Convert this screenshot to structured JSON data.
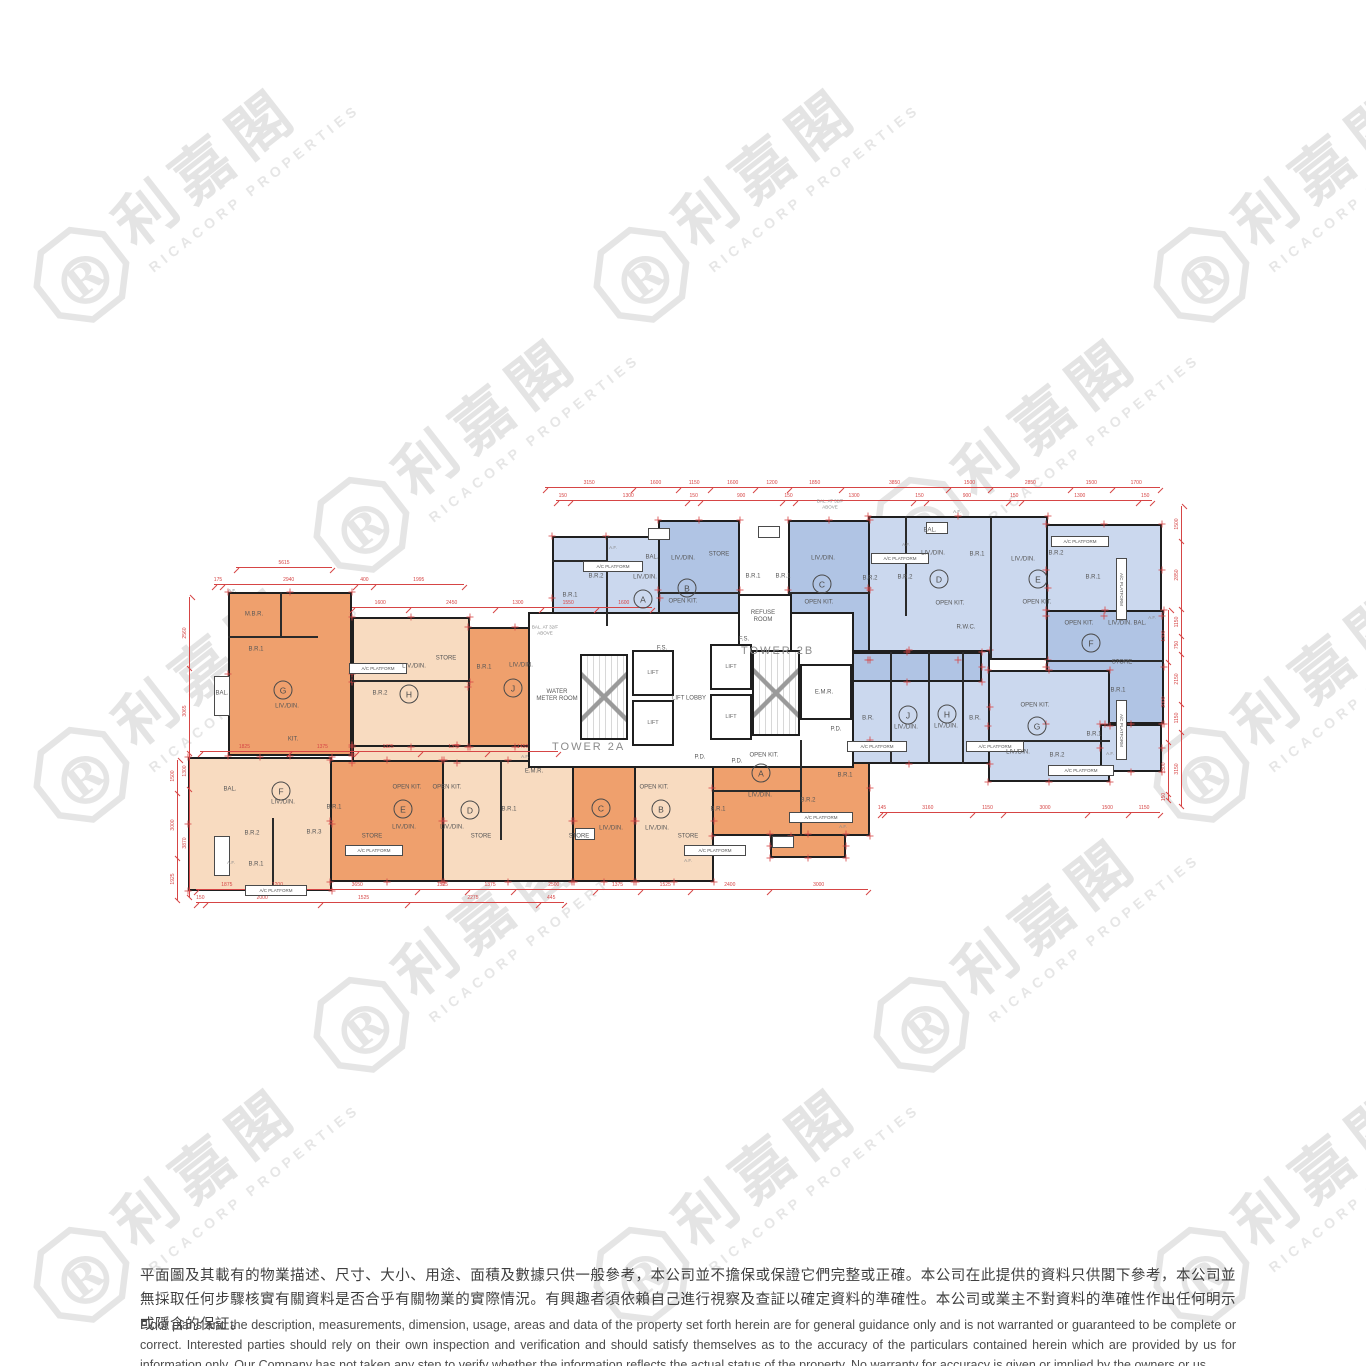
{
  "watermark": {
    "logo_letter": "R",
    "cjk": "利嘉閣",
    "latin": "RICACORP PROPERTIES"
  },
  "disclaimer": {
    "zh": "平面圖及其載有的物業描述、尺寸、大小、用途、面積及數據只供一般參考，本公司並不擔保或保證它們完整或正確。本公司在此提供的資料只供閣下參考，本公司並無採取任何步驟核實有關資料是否合乎有關物業的實際情況。有興趣者須依賴自己進行視察及查証以確定資料的準確性。本公司或業主不對資料的準確性作出任何明示或隱含的保証。",
    "en": "Floor plans and the description, measurements, dimension, usage, areas and data of the property set forth herein are for general guidance only and is not warranted or guaranteed to be complete or correct.  Interested parties should rely on their own inspection and verification and should satisfy themselves as to the accuracy of the particulars contained herein which are provided by us for information only.  Our Company has not taken any step to verify whether the information reflects the actual status of the property.  No warranty for accuracy is given or implied by the owners or us."
  },
  "plan": {
    "towers": [
      {
        "x": 552,
        "y": 741,
        "label": "TOWER 2A"
      },
      {
        "x": 741,
        "y": 645,
        "label": "TOWER 2B"
      }
    ],
    "blocks": [
      [
        228,
        592,
        124,
        164,
        "do"
      ],
      [
        352,
        617,
        118,
        130,
        "lo"
      ],
      [
        468,
        627,
        94,
        120,
        "do"
      ],
      [
        352,
        745,
        210,
        18,
        "lo"
      ],
      [
        188,
        757,
        144,
        134,
        "lo"
      ],
      [
        330,
        760,
        114,
        122,
        "do"
      ],
      [
        442,
        760,
        132,
        122,
        "lo"
      ],
      [
        572,
        760,
        64,
        122,
        "do"
      ],
      [
        634,
        760,
        80,
        122,
        "lo"
      ],
      [
        712,
        740,
        158,
        96,
        "do"
      ],
      [
        770,
        834,
        76,
        24,
        "do"
      ],
      [
        552,
        536,
        108,
        124,
        "lb"
      ],
      [
        658,
        520,
        82,
        140,
        "db"
      ],
      [
        788,
        520,
        82,
        140,
        "db"
      ],
      [
        868,
        516,
        180,
        144,
        "lb"
      ],
      [
        1046,
        524,
        116,
        92,
        "lb"
      ],
      [
        1046,
        610,
        118,
        114,
        "db"
      ],
      [
        828,
        650,
        162,
        114,
        "lb"
      ],
      [
        832,
        652,
        150,
        30,
        "db"
      ],
      [
        988,
        670,
        122,
        112,
        "lb"
      ],
      [
        1100,
        724,
        62,
        48,
        "lb"
      ],
      [
        528,
        612,
        326,
        156,
        "wh"
      ],
      [
        738,
        594,
        54,
        70,
        "wh"
      ],
      [
        800,
        664,
        52,
        56,
        "wh"
      ]
    ],
    "iwalls": [
      [
        272,
        818,
        1.5,
        73
      ],
      [
        352,
        680,
        118,
        1.5
      ],
      [
        228,
        636,
        90,
        1.5
      ],
      [
        280,
        592,
        1.5,
        44
      ],
      [
        500,
        760,
        1.5,
        80
      ],
      [
        800,
        740,
        1.5,
        96
      ],
      [
        712,
        790,
        90,
        1.5
      ],
      [
        606,
        536,
        1.5,
        90
      ],
      [
        552,
        560,
        54,
        1.5
      ],
      [
        658,
        592,
        82,
        1.5
      ],
      [
        788,
        592,
        82,
        1.5
      ],
      [
        905,
        516,
        1.5,
        100
      ],
      [
        990,
        516,
        1.5,
        144
      ],
      [
        1046,
        660,
        118,
        1.5
      ],
      [
        890,
        652,
        1.5,
        112
      ],
      [
        928,
        652,
        1.5,
        112
      ],
      [
        962,
        652,
        1.5,
        112
      ],
      [
        988,
        740,
        122,
        1.5
      ]
    ],
    "stairs": [
      [
        580,
        654,
        48,
        86
      ],
      [
        752,
        650,
        48,
        86
      ]
    ],
    "lifts": [
      [
        632,
        650,
        42,
        46,
        "LIFT"
      ],
      [
        632,
        700,
        42,
        46,
        "LIFT"
      ],
      [
        710,
        644,
        42,
        46,
        "LIFT"
      ],
      [
        710,
        694,
        42,
        46,
        "LIFT"
      ]
    ],
    "boxes": [
      [
        349,
        663,
        58,
        11,
        "A/C PLATFORM",
        false
      ],
      [
        583,
        561,
        60,
        11,
        "A/C PLATFORM",
        false
      ],
      [
        871,
        553,
        58,
        11,
        "A/C PLATFORM",
        false
      ],
      [
        1051,
        536,
        58,
        11,
        "A/C PLATFORM",
        false
      ],
      [
        1116,
        558,
        11,
        62,
        "A/C PLATFORM",
        true
      ],
      [
        789,
        812,
        64,
        11,
        "A/C PLATFORM",
        false
      ],
      [
        684,
        845,
        62,
        11,
        "A/C PLATFORM",
        false
      ],
      [
        345,
        845,
        58,
        11,
        "A/C PLATFORM",
        false
      ],
      [
        245,
        885,
        62,
        11,
        "A/C PLATFORM",
        false
      ],
      [
        847,
        741,
        60,
        11,
        "A/C PLATFORM",
        false
      ],
      [
        966,
        741,
        58,
        11,
        "A/C PLATFORM",
        false
      ],
      [
        1048,
        765,
        66,
        11,
        "A/C PLATFORM",
        false
      ],
      [
        1116,
        700,
        11,
        60,
        "A/C PLATFORM",
        true
      ],
      [
        648,
        528,
        22,
        12,
        "",
        false
      ],
      [
        758,
        526,
        22,
        12,
        "",
        false
      ],
      [
        926,
        522,
        22,
        12,
        "",
        false
      ],
      [
        575,
        828,
        20,
        12,
        "",
        false
      ],
      [
        772,
        836,
        22,
        12,
        "",
        false
      ],
      [
        214,
        676,
        16,
        40,
        "",
        false
      ],
      [
        214,
        836,
        16,
        40,
        "",
        false
      ]
    ],
    "rooms": [
      [
        254,
        615,
        "M.B.R.",
        0
      ],
      [
        256,
        650,
        "B.R.1",
        0
      ],
      [
        287,
        707,
        "LIV./DIN.",
        0
      ],
      [
        222,
        694,
        "BAL.",
        0
      ],
      [
        293,
        740,
        "KIT.",
        0
      ],
      [
        380,
        694,
        "B.R.2",
        0
      ],
      [
        414,
        667,
        "LIV./DIN.",
        0
      ],
      [
        446,
        659,
        "STORE",
        0
      ],
      [
        484,
        668,
        "B.R.1",
        0
      ],
      [
        521,
        666,
        "LIV./DIN.",
        0
      ],
      [
        230,
        790,
        "BAL.",
        0
      ],
      [
        283,
        803,
        "LIV./DIN.",
        0
      ],
      [
        252,
        834,
        "B.R.2",
        0
      ],
      [
        256,
        865,
        "B.R.1",
        0
      ],
      [
        314,
        833,
        "B.R.3",
        0
      ],
      [
        334,
        808,
        "B.R.1",
        0
      ],
      [
        372,
        837,
        "STORE",
        0
      ],
      [
        407,
        788,
        "OPEN KIT.",
        0
      ],
      [
        404,
        828,
        "LIV./DIN.",
        0
      ],
      [
        447,
        788,
        "OPEN KIT.",
        0
      ],
      [
        452,
        828,
        "LIV./DIN.",
        0
      ],
      [
        481,
        837,
        "STORE",
        0
      ],
      [
        509,
        810,
        "B.R.1",
        0
      ],
      [
        579,
        837,
        "STORE",
        0
      ],
      [
        611,
        829,
        "LIV./DIN.",
        0
      ],
      [
        654,
        788,
        "OPEN KIT.",
        0
      ],
      [
        657,
        829,
        "LIV./DIN.",
        0
      ],
      [
        688,
        837,
        "STORE",
        0
      ],
      [
        718,
        810,
        "B.R.1",
        0
      ],
      [
        764,
        756,
        "OPEN KIT.",
        0
      ],
      [
        760,
        796,
        "LIV./DIN.",
        0
      ],
      [
        808,
        801,
        "B.R.2",
        0
      ],
      [
        845,
        776,
        "B.R.1",
        0
      ],
      [
        596,
        577,
        "B.R.2",
        0
      ],
      [
        570,
        596,
        "B.R.1",
        0
      ],
      [
        645,
        578,
        "LIV./DIN.",
        0
      ],
      [
        652,
        558,
        "BAL.",
        0
      ],
      [
        683,
        559,
        "LIV./DIN.",
        0
      ],
      [
        683,
        602,
        "OPEN KIT.",
        0
      ],
      [
        719,
        555,
        "STORE",
        0
      ],
      [
        753,
        577,
        "B.R.1",
        0
      ],
      [
        783,
        577,
        "B.R.1",
        0
      ],
      [
        823,
        559,
        "LIV./DIN.",
        0
      ],
      [
        819,
        603,
        "OPEN KIT.",
        0
      ],
      [
        870,
        579,
        "B.R.2",
        0
      ],
      [
        905,
        578,
        "B.R.2",
        0
      ],
      [
        933,
        554,
        "LIV./DIN.",
        0
      ],
      [
        977,
        555,
        "B.R.1",
        0
      ],
      [
        950,
        604,
        "OPEN KIT.",
        0
      ],
      [
        966,
        628,
        "R.W.C.",
        0
      ],
      [
        930,
        531,
        "BAL.",
        0
      ],
      [
        1023,
        560,
        "LIV./DIN.",
        0
      ],
      [
        1056,
        554,
        "B.R.2",
        0
      ],
      [
        1093,
        578,
        "B.R.1",
        0
      ],
      [
        1037,
        603,
        "OPEN KIT.",
        0
      ],
      [
        1120,
        624,
        "LIV./DIN.",
        0
      ],
      [
        1140,
        624,
        "BAL.",
        0
      ],
      [
        1079,
        624,
        "OPEN KIT.",
        0
      ],
      [
        1122,
        663,
        "STORE",
        0
      ],
      [
        1118,
        691,
        "B.R.1",
        0
      ],
      [
        868,
        719,
        "B.R.",
        0
      ],
      [
        906,
        728,
        "LIV./DIN.",
        0
      ],
      [
        946,
        727,
        "LIV./DIN.",
        0
      ],
      [
        975,
        719,
        "B.R.",
        0
      ],
      [
        1035,
        706,
        "OPEN KIT.",
        0
      ],
      [
        1018,
        753,
        "LIV./DIN.",
        0
      ],
      [
        1057,
        756,
        "B.R.2",
        0
      ],
      [
        1094,
        735,
        "B.R.1",
        0
      ],
      [
        557,
        696,
        "WATER METER ROOM",
        42
      ],
      [
        689,
        699,
        "LIFT LOBBY",
        0
      ],
      [
        824,
        693,
        "E.M.R.",
        0
      ],
      [
        763,
        617,
        "REFUSE ROOM",
        36
      ],
      [
        534,
        772,
        "E.M.R.",
        0
      ],
      [
        700,
        758,
        "P.D.",
        0
      ],
      [
        737,
        762,
        "P.D.",
        0
      ],
      [
        662,
        649,
        "F.S.",
        0
      ],
      [
        744,
        640,
        "F.S.",
        0
      ],
      [
        836,
        730,
        "P.D.",
        0
      ]
    ],
    "units": [
      [
        283,
        690,
        "G"
      ],
      [
        409,
        694,
        "H"
      ],
      [
        513,
        688,
        "J"
      ],
      [
        281,
        791,
        "F"
      ],
      [
        403,
        809,
        "E"
      ],
      [
        470,
        810,
        "D"
      ],
      [
        601,
        808,
        "C"
      ],
      [
        661,
        809,
        "B"
      ],
      [
        761,
        773,
        "A"
      ],
      [
        643,
        599,
        "A"
      ],
      [
        687,
        588,
        "B"
      ],
      [
        822,
        584,
        "C"
      ],
      [
        939,
        579,
        "D"
      ],
      [
        1038,
        579,
        "E"
      ],
      [
        1091,
        643,
        "F"
      ],
      [
        1037,
        726,
        "G"
      ],
      [
        947,
        714,
        "H"
      ],
      [
        908,
        715,
        "J"
      ]
    ],
    "notes": [
      [
        830,
        504,
        "BAL. AT 32/F\nABOVE"
      ],
      [
        545,
        630,
        "BAL. AT 32/F\nABOVE"
      ],
      [
        232,
        591,
        "A.F."
      ],
      [
        525,
        757,
        "A.F."
      ],
      [
        906,
        545,
        "A.F."
      ],
      [
        1152,
        618,
        "A.F."
      ],
      [
        688,
        861,
        "A.F."
      ],
      [
        843,
        827,
        "A.F."
      ],
      [
        231,
        863,
        "A.F."
      ],
      [
        1110,
        754,
        "A.F."
      ],
      [
        957,
        512,
        "A.F."
      ],
      [
        613,
        548,
        "A.F."
      ]
    ],
    "hdims": [
      {
        "x": 545,
        "y": 487,
        "len": 615,
        "vals": [
          "3150",
          "1600",
          "1150",
          "1600",
          "1200",
          "1850",
          "3850",
          "1500",
          "2850",
          "1500",
          "1700"
        ]
      },
      {
        "x": 556,
        "y": 500,
        "len": 596,
        "vals": [
          "150",
          "1300",
          "150",
          "900",
          "150",
          "1300",
          "150",
          "900",
          "150",
          "1300",
          "150"
        ]
      },
      {
        "x": 236,
        "y": 567,
        "len": 96,
        "vals": [
          "5615"
        ]
      },
      {
        "x": 214,
        "y": 584,
        "len": 250,
        "vals": [
          "175",
          "2940",
          "400",
          "1995"
        ]
      },
      {
        "x": 352,
        "y": 607,
        "len": 300,
        "vals": [
          "1600",
          "2450",
          "1300",
          "1550",
          "1600"
        ]
      },
      {
        "x": 196,
        "y": 889,
        "len": 672,
        "vals": [
          "1875",
          "1200",
          "3650",
          "1525",
          "1375",
          "2500",
          "1375",
          "1525",
          "2400",
          "3000"
        ]
      },
      {
        "x": 196,
        "y": 902,
        "len": 368,
        "vals": [
          "150",
          "2000",
          "1525",
          "2275",
          "445"
        ]
      },
      {
        "x": 880,
        "y": 812,
        "len": 280,
        "vals": [
          "145",
          "3160",
          "1150",
          "3000",
          "1500",
          "1150"
        ]
      },
      {
        "x": 200,
        "y": 751,
        "len": 358,
        "vals": [
          "1825",
          "1375",
          "1325",
          "1375",
          "1450"
        ]
      }
    ],
    "vdims": [
      {
        "x": 189,
        "y": 597,
        "len": 300,
        "vals": [
          "2560",
          "3065",
          "1300",
          "3870"
        ]
      },
      {
        "x": 177,
        "y": 760,
        "len": 140,
        "vals": [
          "1500",
          "3000",
          "1925"
        ]
      },
      {
        "x": 1181,
        "y": 506,
        "len": 300,
        "vals": [
          "1500",
          "2850",
          "1150",
          "750",
          "2150",
          "1150",
          "3150"
        ]
      },
      {
        "x": 1168,
        "y": 610,
        "len": 190,
        "vals": [
          "1300",
          "2000",
          "1300",
          "150"
        ]
      }
    ]
  }
}
